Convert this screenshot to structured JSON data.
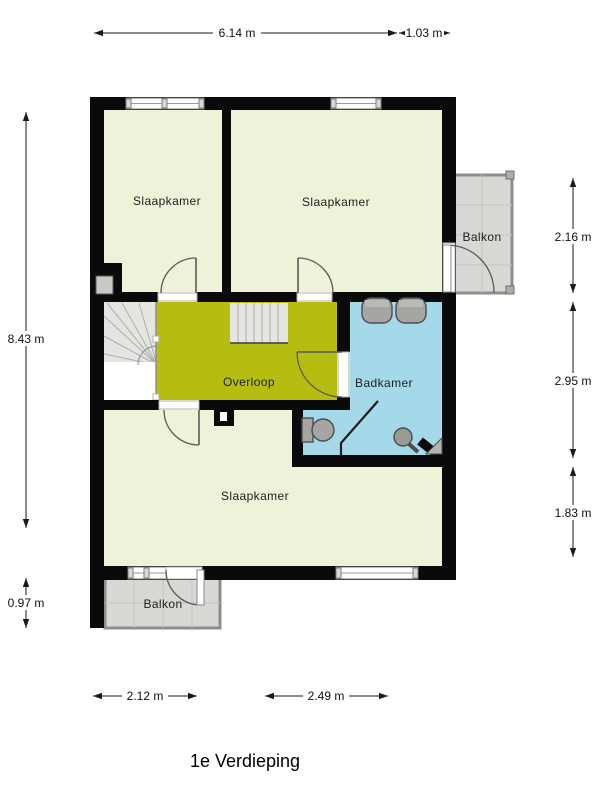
{
  "title": "1e Verdieping",
  "rooms": {
    "bedroom_top_left": {
      "label": "Slaapkamer"
    },
    "bedroom_top_right": {
      "label": "Slaapkamer"
    },
    "bedroom_bottom": {
      "label": "Slaapkamer"
    },
    "landing": {
      "label": "Overloop"
    },
    "bathroom": {
      "label": "Badkamer"
    },
    "balcony_right": {
      "label": "Balkon"
    },
    "balcony_bottom": {
      "label": "Balkon"
    }
  },
  "dimensions": {
    "top": [
      {
        "value": "6.14 m"
      },
      {
        "value": "1.03 m"
      }
    ],
    "left": [
      {
        "value": "8.43 m"
      },
      {
        "value": "0.97 m"
      }
    ],
    "right": [
      {
        "value": "2.16 m"
      },
      {
        "value": "2.95 m"
      },
      {
        "value": "1.83 m"
      }
    ],
    "bottom": [
      {
        "value": "2.12 m"
      },
      {
        "value": "2.49 m"
      }
    ]
  },
  "colors": {
    "wall": "#0a0a0a",
    "bedroom_fill": "#edf3d9",
    "landing_fill": "#b6bd10",
    "bathroom_fill": "#a4d9e9",
    "balcony_fill": "#d8d8d4"
  }
}
